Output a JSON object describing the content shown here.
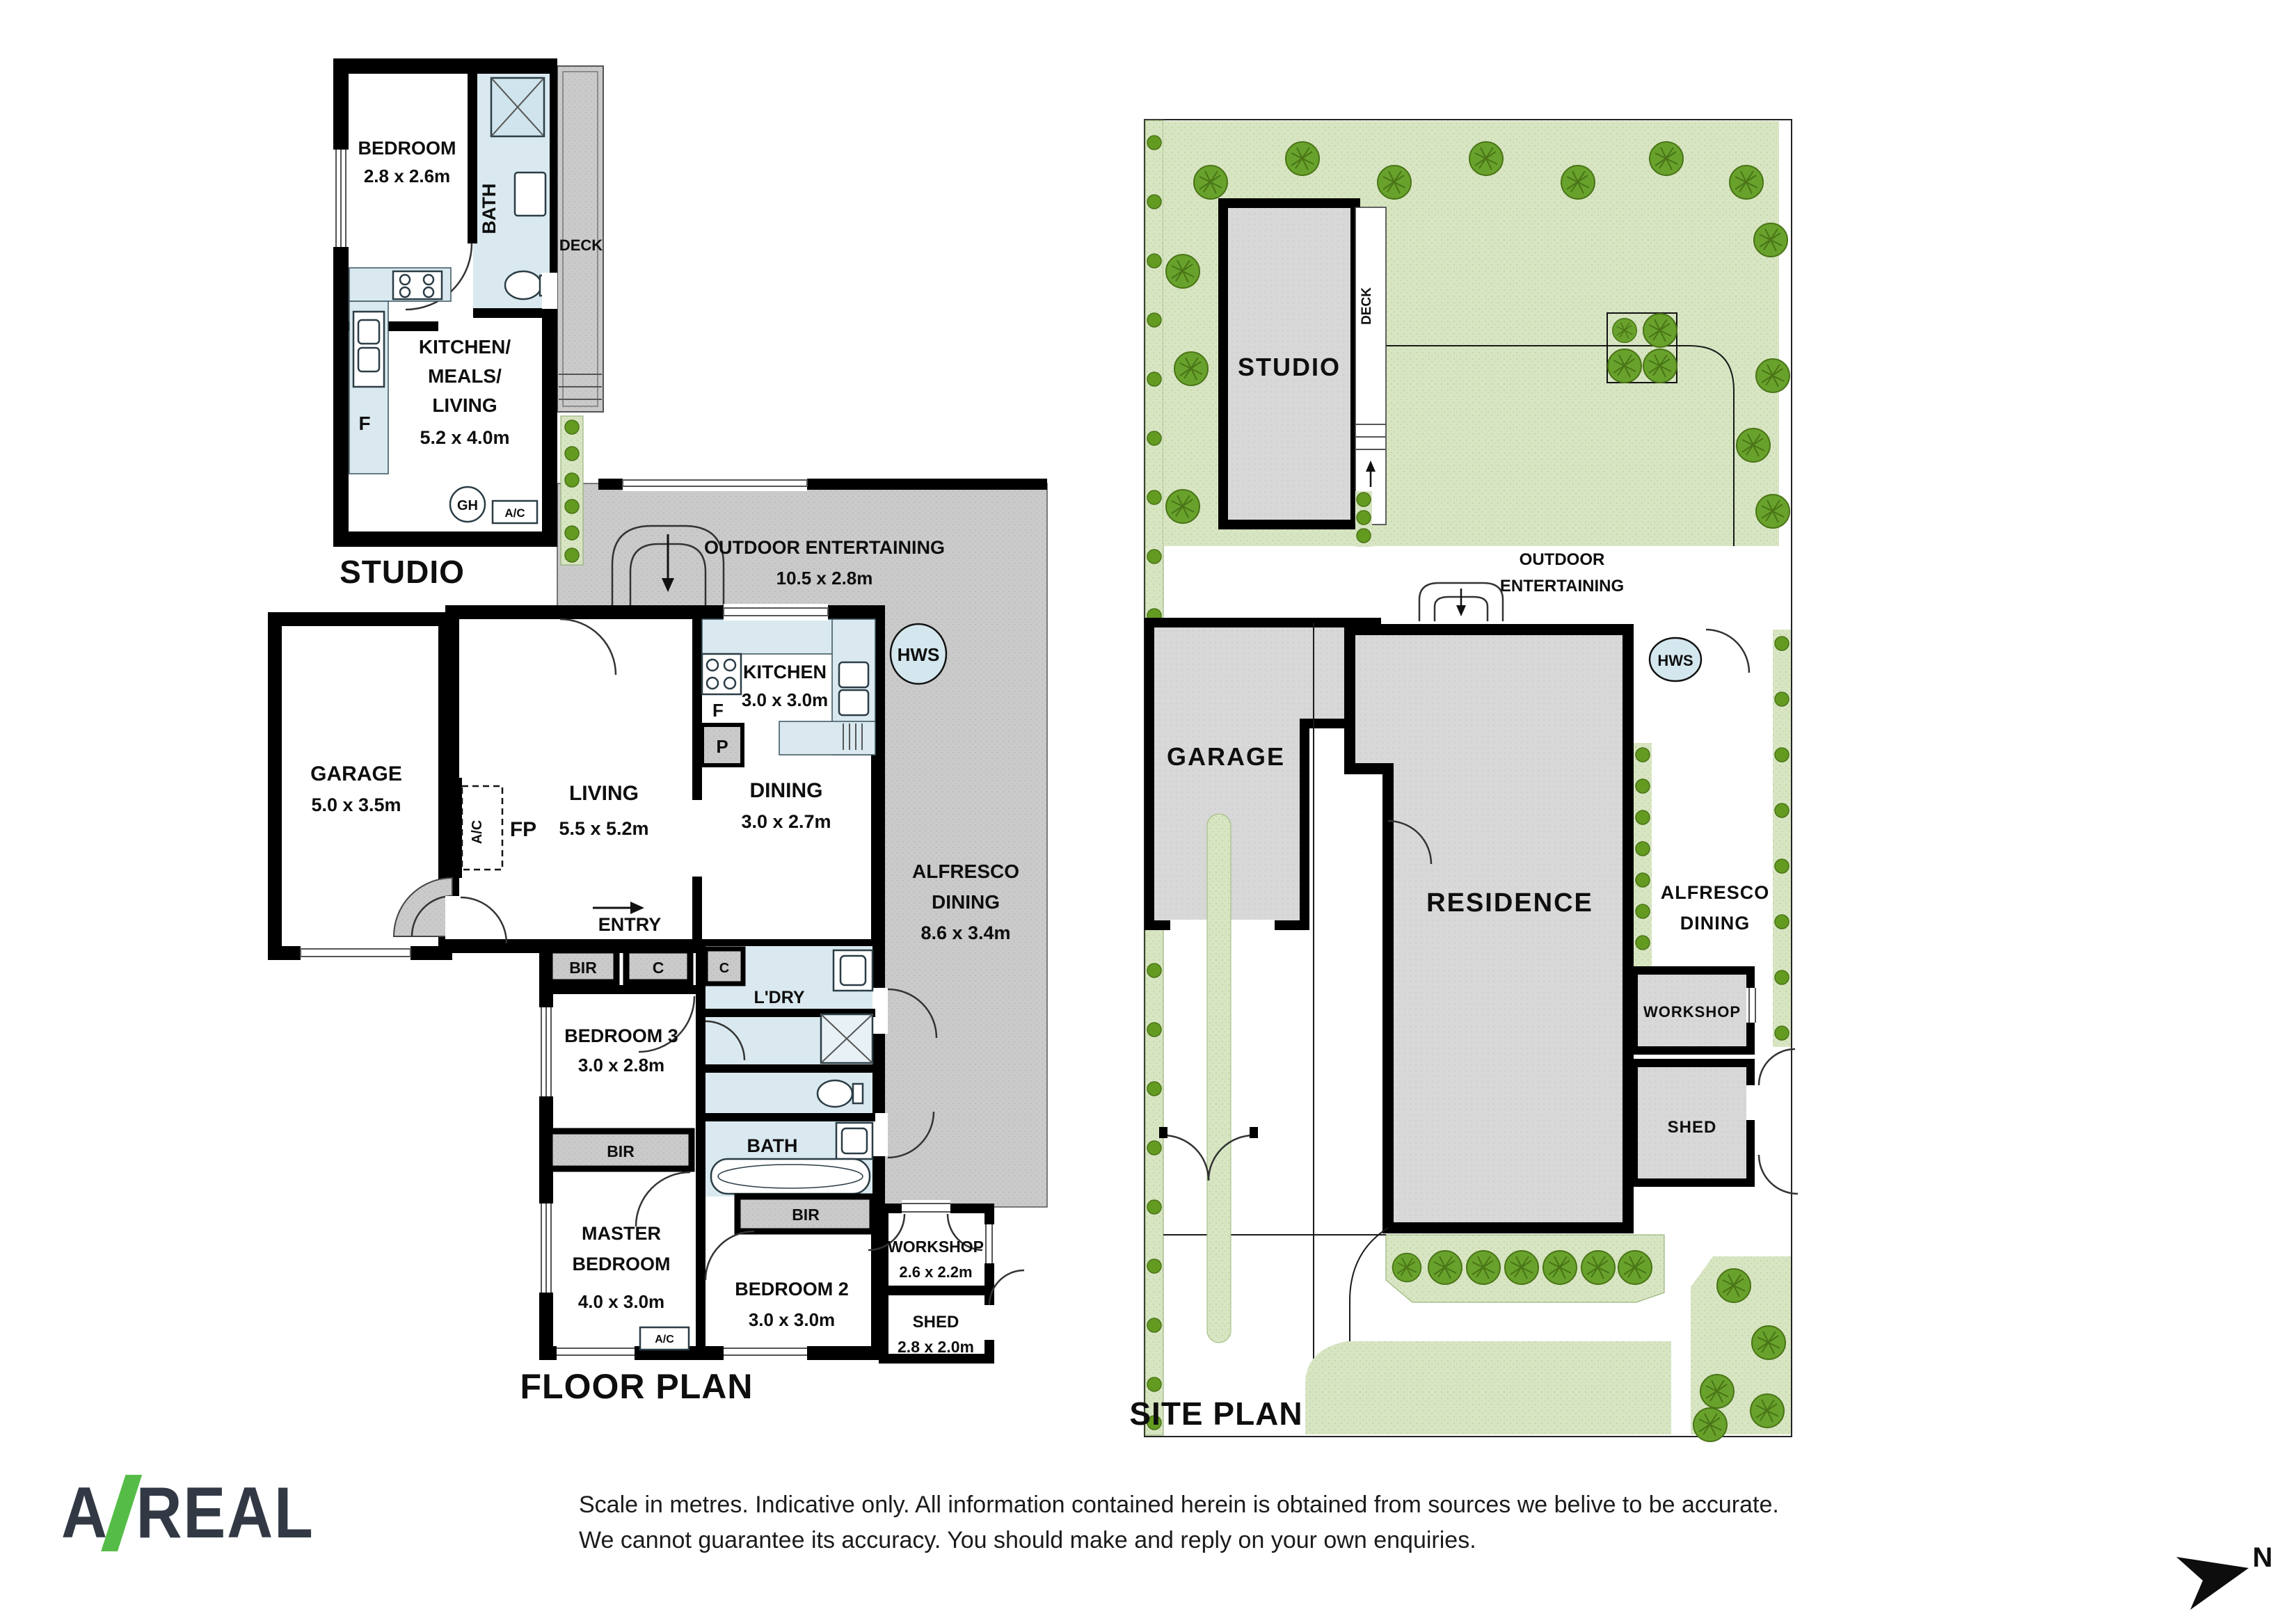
{
  "floor_plan": {
    "title": "FLOOR PLAN",
    "studio": {
      "title": "STUDIO",
      "bedroom_name": "BEDROOM",
      "bedroom_dims": "2.8 x 2.6m",
      "bath": "BATH",
      "deck": "DECK",
      "kml_1": "KITCHEN/",
      "kml_2": "MEALS/",
      "kml_3": "LIVING",
      "kml_dims": "5.2 x 4.0m",
      "fridge": "F",
      "gh": "GH",
      "ac": "A/C"
    },
    "outdoor_entertaining_name": "OUTDOOR ENTERTAINING",
    "outdoor_entertaining_dims": "10.5 x 2.8m",
    "garage_name": "GARAGE",
    "garage_dims": "5.0 x 3.5m",
    "living_name": "LIVING",
    "living_dims": "5.5 x 5.2m",
    "ac": "A/C",
    "fp": "FP",
    "entry": "ENTRY",
    "kitchen_name": "KITCHEN",
    "kitchen_dims": "3.0 x 3.0m",
    "fridge": "F",
    "pantry": "P",
    "dining_name": "DINING",
    "dining_dims": "3.0 x 2.7m",
    "hws": "HWS",
    "alfresco_1": "ALFRESCO",
    "alfresco_2": "DINING",
    "alfresco_dims": "8.6 x 3.4m",
    "closet": "C",
    "closet2": "C",
    "laundry": "L'DRY",
    "bir1": "BIR",
    "bir2": "BIR",
    "bir3": "BIR",
    "bath_name": "BATH",
    "bedroom3_name": "BEDROOM 3",
    "bedroom3_dims": "3.0 x 2.8m",
    "master_1": "MASTER",
    "master_2": "BEDROOM",
    "master_dims": "4.0 x 3.0m",
    "bedroom2_name": "BEDROOM 2",
    "bedroom2_dims": "3.0 x 3.0m",
    "workshop_name": "WORKSHOP",
    "workshop_dims": "2.6 x 2.2m",
    "shed_name": "SHED",
    "shed_dims": "2.8 x 2.0m",
    "ac_master": "A/C"
  },
  "site_plan": {
    "title": "SITE PLAN",
    "studio": "STUDIO",
    "deck": "DECK",
    "outdoor_1": "OUTDOOR",
    "outdoor_2": "ENTERTAINING",
    "garage": "GARAGE",
    "residence": "RESIDENCE",
    "hws": "HWS",
    "alfresco_1": "ALFRESCO",
    "alfresco_2": "DINING",
    "workshop": "WORKSHOP",
    "shed": "SHED"
  },
  "footer": {
    "logo_a": "A",
    "logo_real": "REAL",
    "disclaimer_1": "Scale in metres. Indicative only. All information contained herein is obtained from sources we belive to be accurate.",
    "disclaimer_2": "We cannot guarantee its accuracy. You should make and reply on your own enquiries.",
    "north": "N"
  },
  "colors": {
    "wall": "#000000",
    "paving_gray": "#cacaca",
    "building_gray": "#d8d8d8",
    "wet_blue": "#d9e9ef",
    "lawn_green": "#d8e5c3",
    "tree_green": "#68a22c",
    "logo_dark": "#323945",
    "logo_green": "#55bd47"
  }
}
